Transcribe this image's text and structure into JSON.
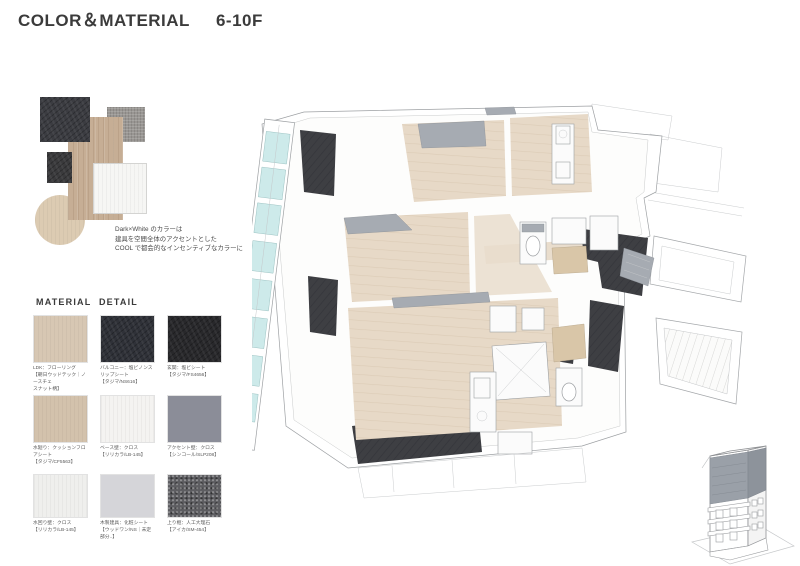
{
  "header": {
    "title": "COLOR＆MATERIAL",
    "floors": "6-10F"
  },
  "concept": {
    "description_lines": [
      "Dark×White のカラーは",
      "建具を空間全体のアクセントとした",
      "COOL で都会的なインセンティブなカラーに"
    ],
    "collage_swatches": [
      {
        "name": "dark-fabric-swatch",
        "color": "#3b3c41"
      },
      {
        "name": "wood-panel-swatch",
        "color": "#c6ae95"
      },
      {
        "name": "gray-fabric-swatch",
        "color": "#999693"
      },
      {
        "name": "dark-stone-swatch",
        "color": "#3a3a3c"
      },
      {
        "name": "white-panel-swatch",
        "color": "#f6f6f4"
      },
      {
        "name": "beige-circle-swatch",
        "color": "#dccbb2"
      }
    ]
  },
  "materials": {
    "heading": "MATERIAL DETAIL",
    "items": [
      {
        "color": "#d7c7b3",
        "lines": [
          "LDK：フローリング",
          "【朝日ウッドテック｜ノースチェ",
          "スナット柄】"
        ]
      },
      {
        "color": "#2f3138",
        "lines": [
          "バルコニー：塩ビノンスリップシート",
          "【タジマ/NS616】"
        ]
      },
      {
        "color": "#28282b",
        "lines": [
          "玄関：塩ビシート",
          "【タジマ/FS4656】"
        ]
      },
      {
        "color": "#d3c2ac",
        "lines": [
          "水廻り：クッションフロアシート",
          "【タジマ/CF5563】"
        ]
      },
      {
        "color": "#f4f3f1",
        "lines": [
          "ベース壁：クロス",
          "【リリカラ/LB-145】"
        ]
      },
      {
        "color": "#8b8d98",
        "lines": [
          "アクセント壁：クロス",
          "【シンコール/SLP208】"
        ]
      },
      {
        "color": "#efefed",
        "lines": [
          "水回り壁：クロス",
          "【リリカラ/LB-145】"
        ]
      },
      {
        "color": "#d5d5d9",
        "lines": [
          "木製建具：化粧シート",
          "【ウッドワン/NS｜未定部分..】"
        ]
      },
      {
        "color": "#5d5d61",
        "lines": [
          "上り框：人工大理石",
          "【アイカ/SM-454】"
        ]
      }
    ]
  },
  "building": {
    "highlight_floors": "6-10F",
    "highlight_color": "#9aa0a8"
  }
}
